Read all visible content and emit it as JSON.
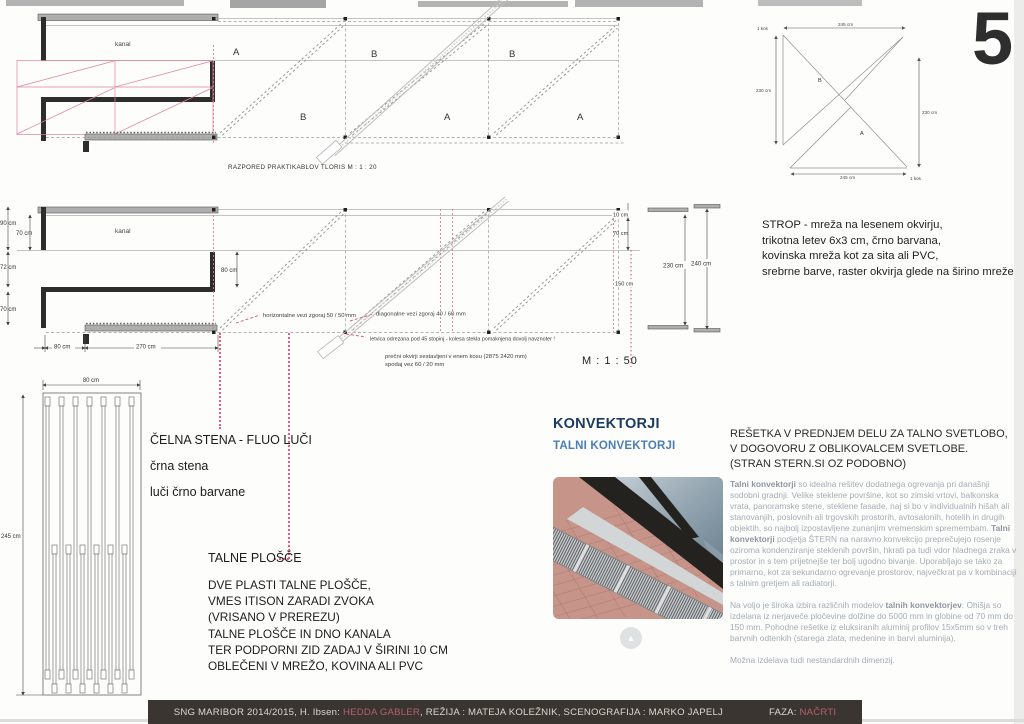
{
  "sheet": {
    "number": "5"
  },
  "plan": {
    "kanal_label": "kanal",
    "caption": "RAZPORED PRAKTIKABLOV   TLORIS   M : 1 : 20",
    "bays": [
      "A",
      "B",
      "B",
      "A",
      "B",
      "A"
    ]
  },
  "detail": {
    "label_b": "B",
    "label_a": "A",
    "kos_top": "1 kos",
    "kos_bottom": "1 kos",
    "dim_top": "245 cm",
    "dim_left": "230 cm",
    "dim_right": "230 cm",
    "dim_bottom": "245 cm"
  },
  "section": {
    "kanal_label": "kanal",
    "scale": "M : 1 : 50",
    "dims_left": [
      "90 cm",
      "70 cm",
      "72 cm",
      "70 cm"
    ],
    "dim_inner": "80 cm",
    "dims_bottom": [
      "80 cm",
      "270 cm"
    ],
    "dim_10": "10 cm",
    "dim_70": "70 cm",
    "dim_150": "150 cm",
    "dim_230": "230 cm",
    "dim_240": "240 cm",
    "note_horizontal": "horizontalne vezi zgoraj 50 / 50 mm",
    "note_diagonal": "diagonalne vezi zgoraj 40 / 60 mm",
    "note_letvica": "letvica odrezana pod 45 stopinj - kolesa stekla pomaknjena dovolj navznoter !",
    "note_frames_1": "prečni okvirji sestavljeni v enem kosu (2875  2420 mm)",
    "note_frames_2": "spodaj vez 60 / 20 mm"
  },
  "strop_note": {
    "lines": [
      "STROP - mreža na lesenem okvirju,",
      "trikotna letev 6x3 cm, črno barvana,",
      "kovinska mreža kot za sita ali PVC,",
      "srebrne barve, raster okvirja glede na širino mreže"
    ]
  },
  "fluo": {
    "dim_width": "80 cm",
    "dim_height": "245 cm"
  },
  "annotations": {
    "celna": "ČELNA STENA - FLUO LUČI",
    "crna": "črna stena",
    "luci": "luči črno barvane",
    "talne_title": "TALNE PLOŠČE",
    "block1": [
      "DVE PLASTI TALNE PLOŠČE,",
      "VMES ITISON ZARADI ZVOKA",
      "(VRISANO V PREREZU)"
    ],
    "block2": [
      "TALNE PLOŠČE IN DNO KANALA",
      "TER PODPORNI ZID ZADAJ V ŠIRINI 10 CM",
      "OBLEČENI V MREŽO, KOVINA ALI PVC"
    ]
  },
  "konvektorji": {
    "title": "KONVEKTORJI",
    "subtitle": "TALNI KONVEKTORJI",
    "resetka_lines": [
      "REŠETKA V PREDNJEM DELU ZA TALNO SVETLOBO,",
      "V DOGOVORU Z OBLIKOVALCEM SVETLOBE.",
      "(STRAN STERN.SI OZ PODOBNO)"
    ],
    "p1_bold1": "Talni konvektorji",
    "p1_text1": " so idealna rešitev dodatnega ogrevanja pri današnji sodobni gradnji. Velike steklene površine, kot so zimski vrtovi, balkonska vrata, panoramske stene, steklene fasade, naj si bo v individualnih hišah ali stanovanjih, poslovnih ali trgovskih prostorih, avtosalonih, hotelih in drugih objektih, so najbolj izpostavljene zunanjim vremenskim spremembam. ",
    "p1_bold2": "Talni konvektorji",
    "p1_text2": " podjetja ŠTERN na naravno konvekcijo preprečujejo rosenje oziroma kondenziranje steklenih površin, hkrati pa tudi vdor hladnega zraka v prostor in s tem prijetnejše ter bolj ugodno bivanje. Uporabljajo se tako za primarno, kot za sekundarno ogrevanje prostorov, največkrat pa v kombinaciji s talnim gretjem ali radiatorji.",
    "p2_text1": "Na voljo je široka izbira različnih modelov ",
    "p2_bold": "talnih konvektorjev",
    "p2_text2": ". Ohišja so izdelana iz nerjaveče pločevine dolžine do 5000 mm in globine od 70 mm do 150 mm. Pohodne rešetke iz eluksiranih aluminij profilov 15x5mm so v treh barvnih odtenkih (starega zlata, medenine in barvi aluminija).",
    "p3": "Možna izdelava tudi nestandardnih dimenzij."
  },
  "footer": {
    "part1": "SNG MARIBOR 2014/2015, H. Ibsen: ",
    "highlight1": "HEDDA GABLER",
    "part2": ", REŽIJA : MATEJA KOLEŽNIK, SCENOGRAFIJA : MARKO JAPELJ",
    "faza_label": "FAZA: ",
    "highlight2": "NAČRTI"
  },
  "colors": {
    "accent_pink": "#e06080",
    "title_blue_dark": "#1d3c60",
    "title_blue_light": "#4a7fb5",
    "footer_bg": "#3a3531",
    "footer_highlight": "#b4606e"
  }
}
